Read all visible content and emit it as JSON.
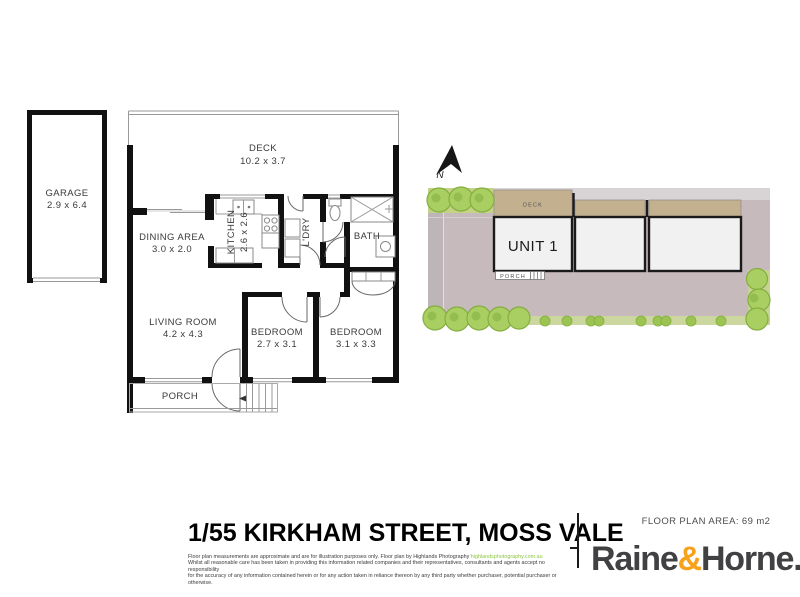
{
  "plan": {
    "garage": {
      "name": "GARAGE",
      "dims": "2.9 x 6.4"
    },
    "deck": {
      "name": "DECK",
      "dims": "10.2 x 3.7"
    },
    "dining": {
      "name": "DINING AREA",
      "dims": "3.0 x 2.0"
    },
    "kitchen": {
      "name": "KITCHEN",
      "dims": "2.6 x 2.6"
    },
    "laundry": {
      "name": "L'DRY"
    },
    "bath": {
      "name": "BATH"
    },
    "living": {
      "name": "LIVING ROOM",
      "dims": "4.2 x 4.3"
    },
    "bedroom1": {
      "name": "BEDROOM",
      "dims": "2.7 x 3.1"
    },
    "bedroom2": {
      "name": "BEDROOM",
      "dims": "3.1 x 3.3"
    },
    "porch": {
      "name": "PORCH"
    }
  },
  "site": {
    "north": "N",
    "unit1": "UNIT 1",
    "deck": "DECK",
    "porch": "PORCH"
  },
  "footer": {
    "address": "1/55 KIRKHAM STREET, MOSS VALE",
    "area": "FLOOR PLAN AREA: 69 m2",
    "disclaimer1": "Floor plan measurements are approximate and are for illustration purposes only. Floor plan by Highlands Photography ",
    "disclaimer_link": "highlandsphotography.com.au",
    "disclaimer2": "Whilst all reasonable care has been taken in providing this information related companies and their representatives, consultants and agents accept no responsibility",
    "disclaimer3": "for the accuracy of any information contained herein or for any action taken in reliance thereon by any third party whether purchaser, potential purchaser or otherwise.",
    "brand_raine": "Raine",
    "brand_amp": "&",
    "brand_horne": "Horne",
    "brand_period": "."
  },
  "colors": {
    "wall": "#111111",
    "site_ground": "#c6babd",
    "site_deck_tan": "#c3b08f",
    "grass_green": "#a9ce62",
    "brand_amber": "#f6a21c",
    "link_green": "#8dc63f"
  }
}
